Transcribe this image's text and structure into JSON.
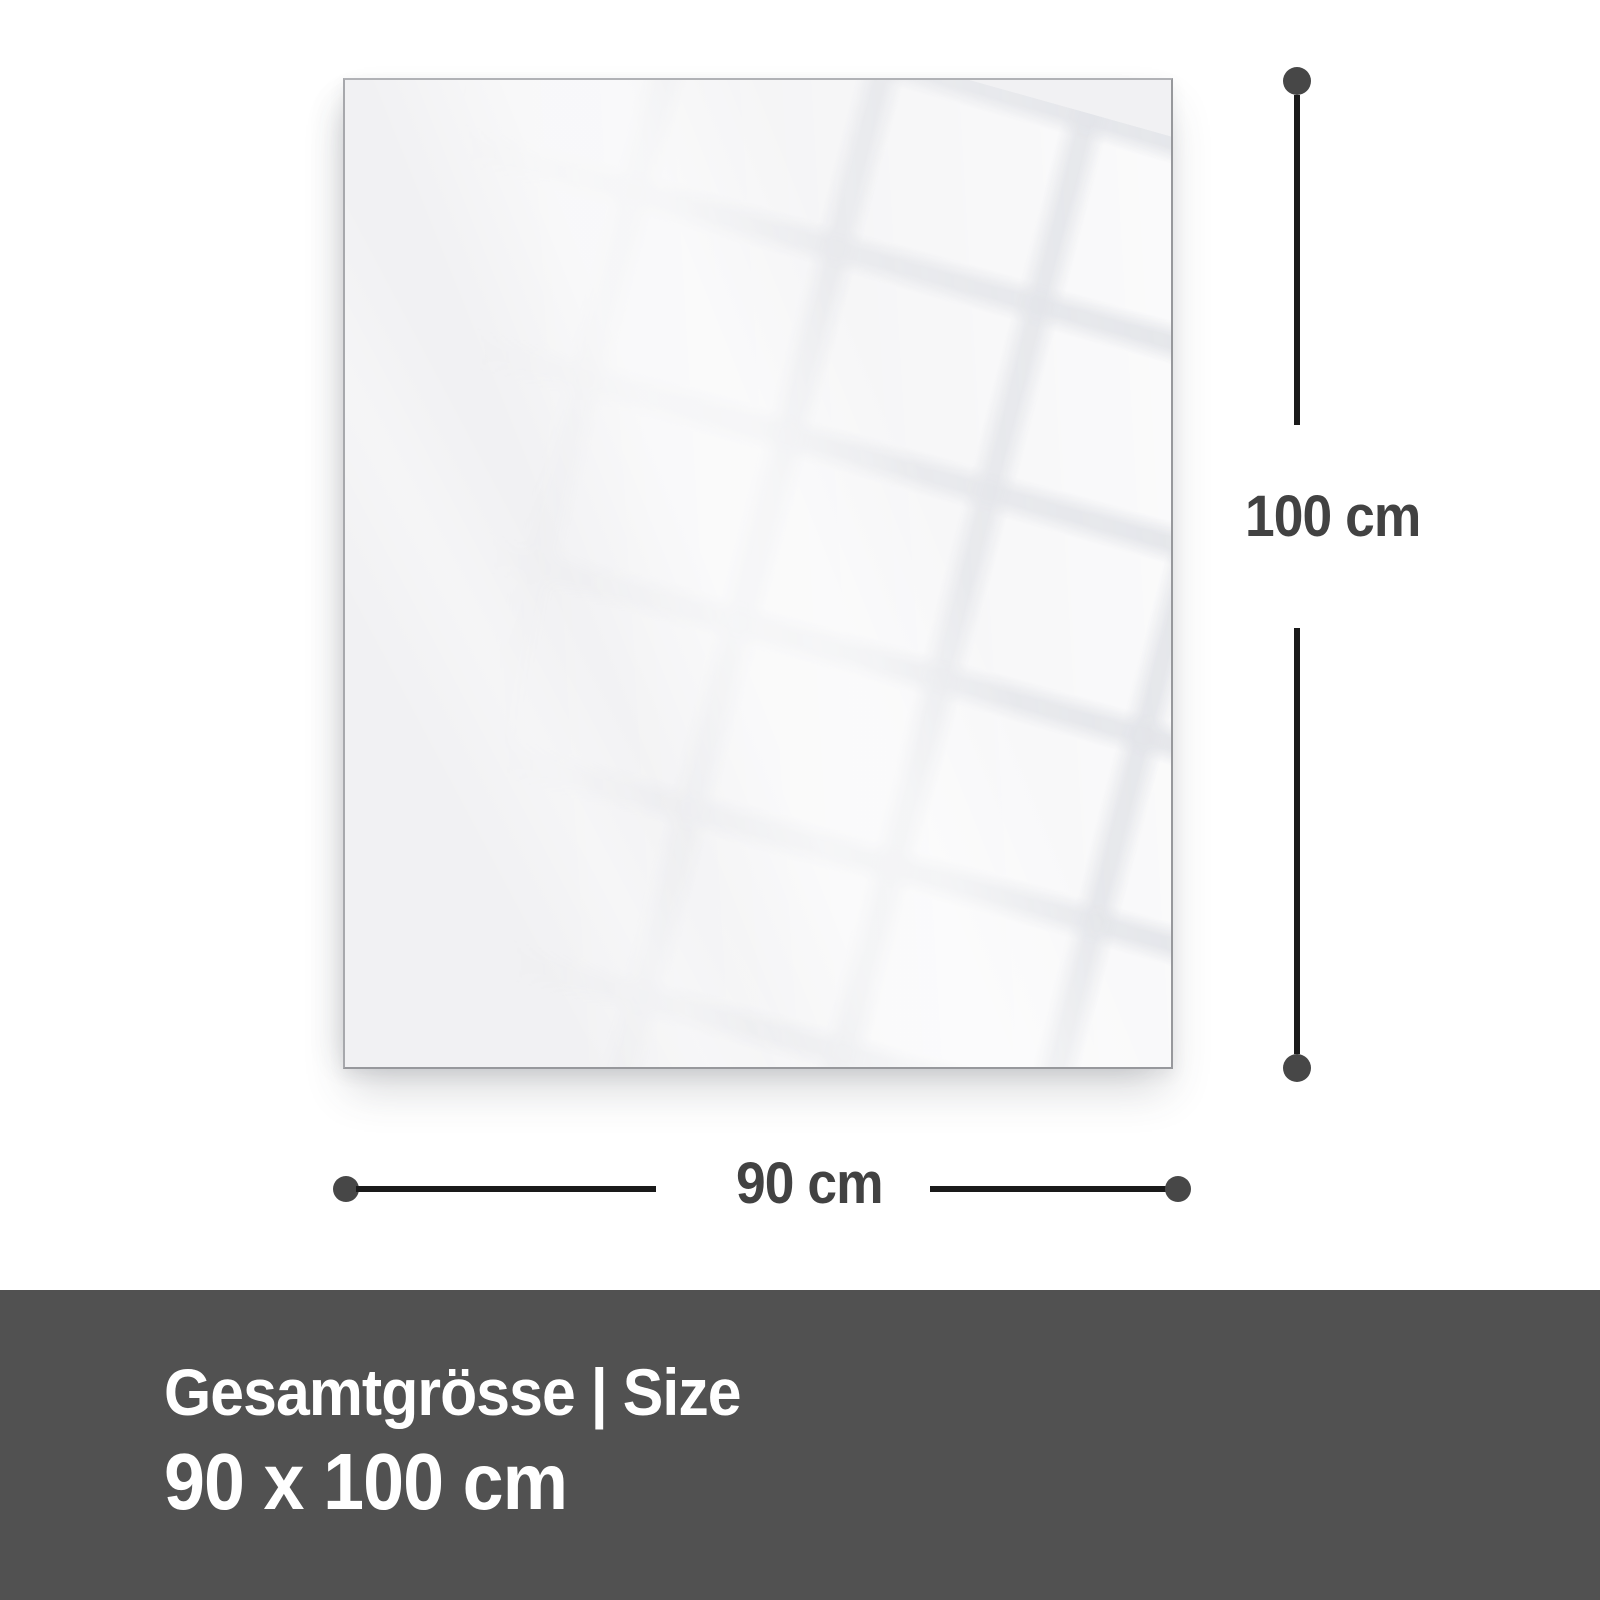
{
  "diagram": {
    "height_dimension": {
      "label": "100 cm"
    },
    "width_dimension": {
      "label": "90 cm"
    }
  },
  "banner": {
    "title": "Gesamtgrösse | Size",
    "size": "90 x 100 cm"
  },
  "colors": {
    "page_background": "#ffffff",
    "panel_fill": "#f1f1f3",
    "panel_border": "#9fa0a4",
    "dimension_line": "#1a1a1a",
    "endpoint_dot": "#474747",
    "dimension_text": "#424242",
    "banner_background": "#515151",
    "banner_text": "#ffffff"
  }
}
